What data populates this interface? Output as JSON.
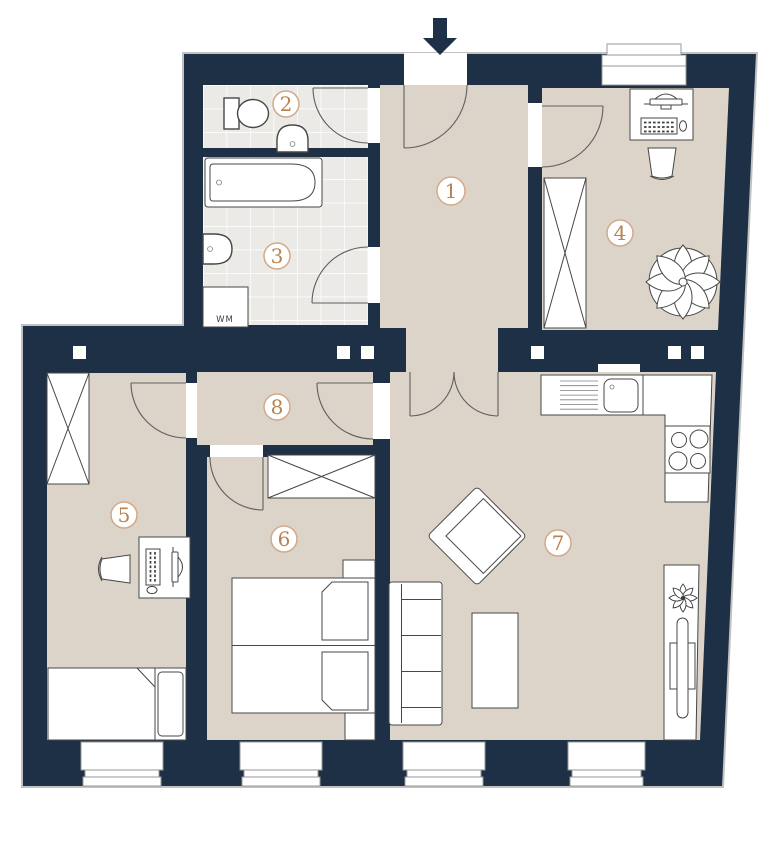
{
  "floor_plan": {
    "rooms": [
      {
        "number": "1"
      },
      {
        "number": "2"
      },
      {
        "number": "3"
      },
      {
        "number": "4"
      },
      {
        "number": "5"
      },
      {
        "number": "6"
      },
      {
        "number": "7"
      },
      {
        "number": "8"
      }
    ],
    "labels": {
      "washing_machine": "WM"
    },
    "icons": {
      "entrance": "arrow-down"
    },
    "colors": {
      "wall": "#1e3045",
      "floor": "#dcd4c9",
      "tile": "#ebeae6",
      "accent_number": "#b9824f",
      "circle_border": "#d2a98b",
      "stroke": "#474747"
    }
  }
}
